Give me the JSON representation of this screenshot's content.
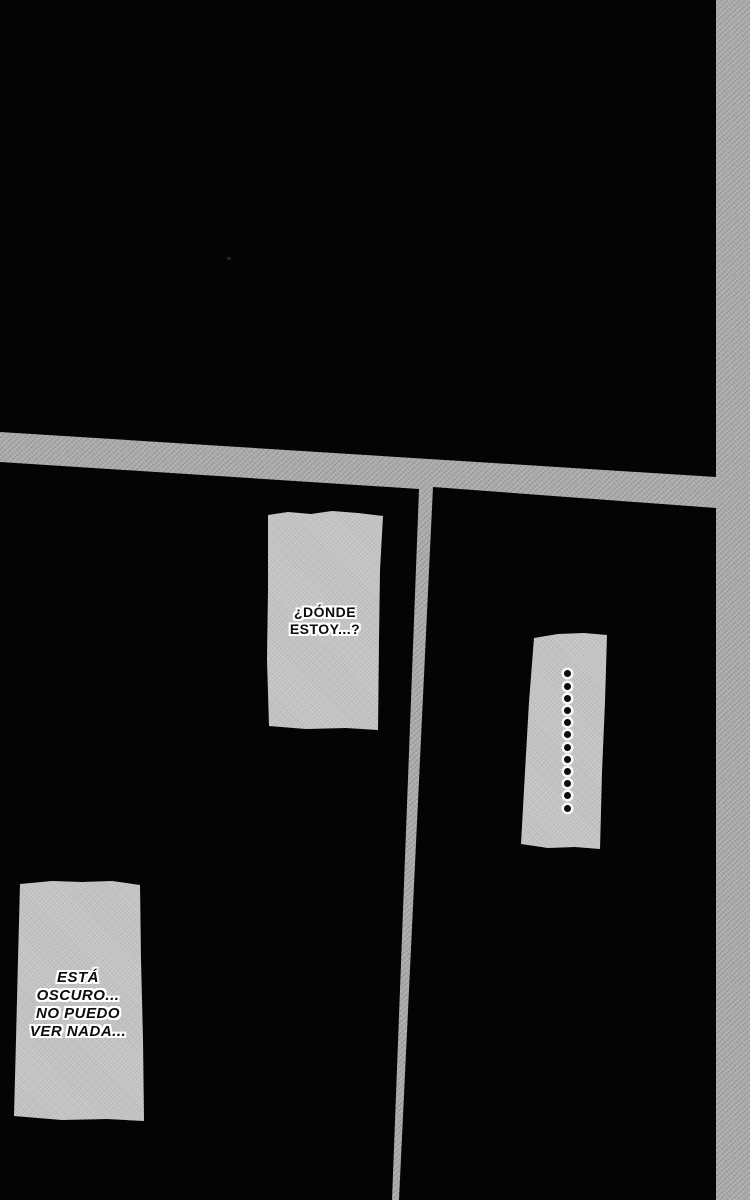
{
  "page": {
    "kind": "manga page scan",
    "colors": {
      "paper_gray": "#a9a9a9",
      "panel_black": "#040404",
      "caption_gray": "#cacaca",
      "ink": "#0c0c0c",
      "outline_white": "#ffffff",
      "dot_halo": "#f8f8f8"
    }
  },
  "captions": {
    "where_am_i": {
      "lines": [
        "¿DÓNDE",
        "ESTOY...?"
      ]
    },
    "silence": {
      "dot_count": 12
    },
    "its_dark": {
      "lines": [
        "ESTÁ",
        "OSCURO...",
        "NO PUEDO",
        "VER NADA..."
      ]
    }
  }
}
